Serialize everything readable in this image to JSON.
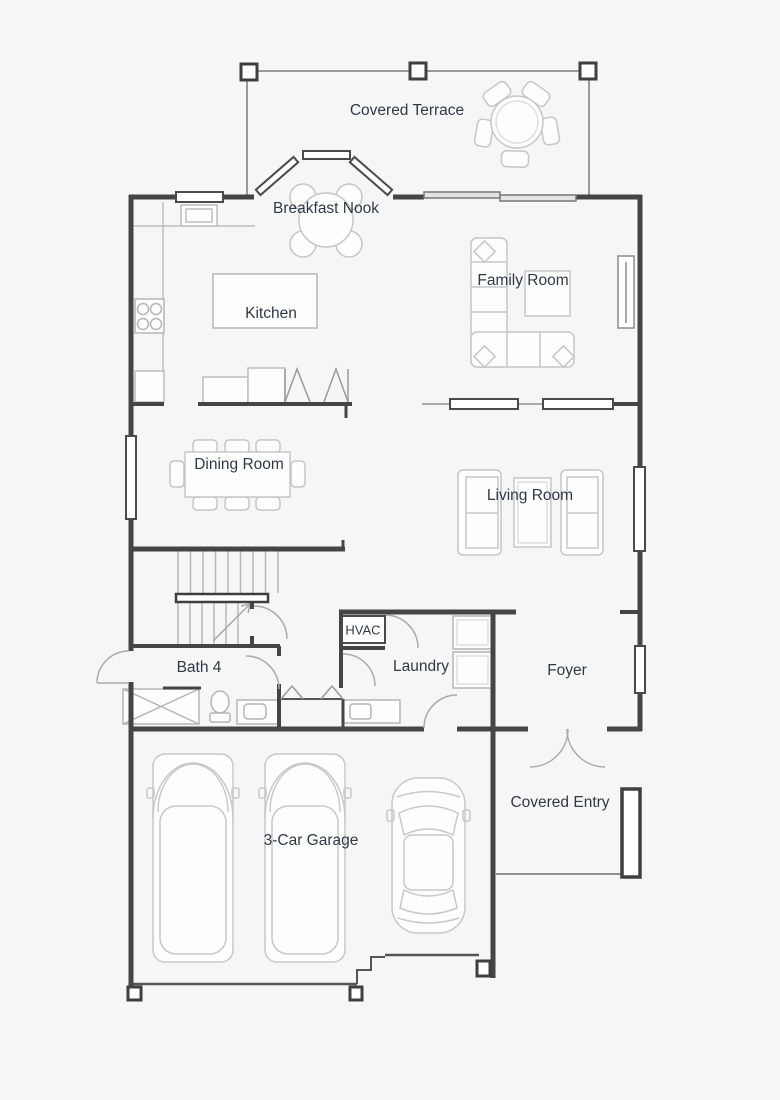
{
  "plan": {
    "type": "residential-first-floor-plan",
    "rooms": {
      "covered_terrace": {
        "label": "Covered Terrace"
      },
      "breakfast_nook": {
        "label": "Breakfast Nook"
      },
      "kitchen": {
        "label": "Kitchen"
      },
      "family_room": {
        "label": "Family Room"
      },
      "dining_room": {
        "label": "Dining Room"
      },
      "living_room": {
        "label": "Living Room"
      },
      "hvac": {
        "label": "HVAC"
      },
      "laundry": {
        "label": "Laundry"
      },
      "bath_4": {
        "label": "Bath 4"
      },
      "foyer": {
        "label": "Foyer"
      },
      "garage": {
        "label": "3-Car Garage"
      },
      "covered_entry": {
        "label": "Covered Entry"
      }
    },
    "colors": {
      "bg": "#f6f6f7",
      "wall": "#454545",
      "thin": "#999999",
      "furn": "#c6c6c6",
      "text": "#2e3a47",
      "window_fill": "#ffffff"
    }
  }
}
